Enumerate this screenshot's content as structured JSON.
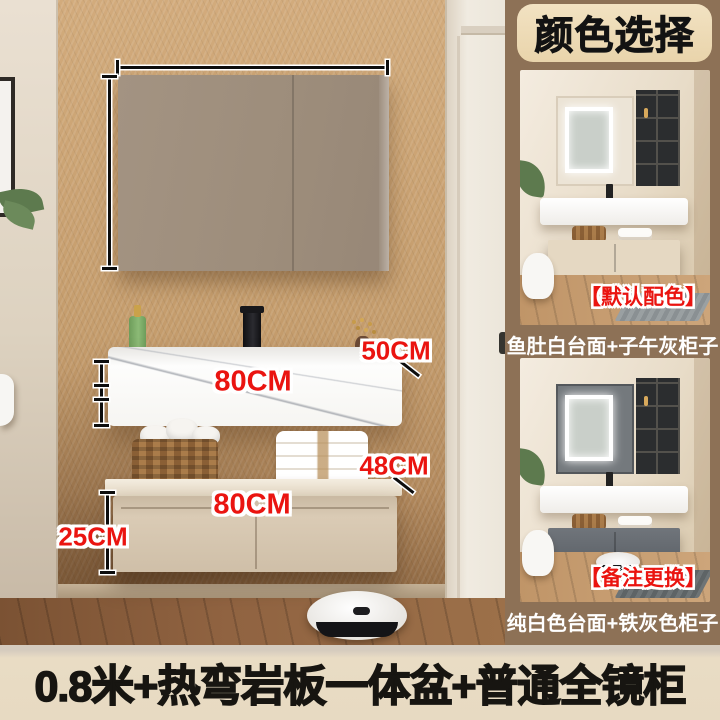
{
  "measurements": {
    "label_50": "50CM",
    "label_80_upper": "80CM",
    "label_48": "48CM",
    "label_80_lower": "80CM",
    "label_25": "25CM"
  },
  "color_panel": {
    "header": "颜色选择",
    "variants": [
      {
        "tag": "【默认配色】",
        "caption": "鱼肚白台面+子午灰柜子"
      },
      {
        "tag": "【备注更换】",
        "caption": "纯白色台面+铁灰色柜子"
      }
    ]
  },
  "footer": {
    "title": "0.8米+热弯岩板一体盆+普通全镜柜"
  },
  "colors": {
    "accent_red": "#ea1410",
    "panel_brown": "#8d7156",
    "header_cream": "#eedcba",
    "banner_cream": "#e8dbc3",
    "wall_tan": "#c7a06f",
    "caption_white": "#ffffff",
    "title_black": "#171511"
  }
}
